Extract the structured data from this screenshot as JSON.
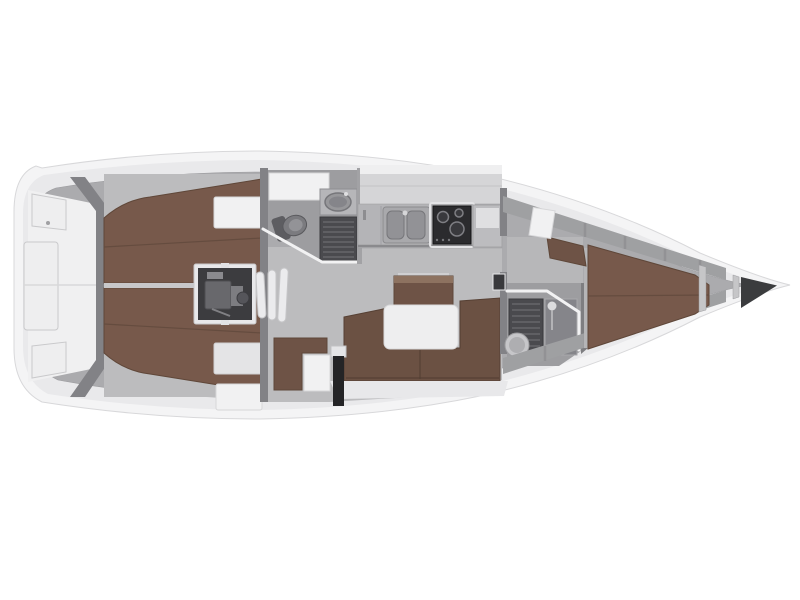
{
  "figure": "sailing-yacht-interior-deck-plan",
  "orientation": {
    "bow": "right",
    "stern": "left"
  },
  "rooms": [
    "aft-cabin-port",
    "aft-cabin-starboard",
    "engine-compartment",
    "companionway-steps",
    "aft-head",
    "galley",
    "saloon",
    "nav-station",
    "forward-head",
    "forward-cabin",
    "anchor-locker"
  ],
  "fixtures": [
    "double-berth-port",
    "double-berth-starboard",
    "engine-block",
    "toilet",
    "wash-basin",
    "shower-grate",
    "double-sink",
    "stove-oven",
    "saloon-table",
    "u-shaped-settee",
    "sideboard",
    "chart-table",
    "nav-seat",
    "mast-post",
    "v-berth",
    "vanity-seat",
    "wardrobe-lockers"
  ],
  "colors": {
    "bg": "#ffffff",
    "hull": "#f4f4f5",
    "hullEdge": "#d8d8da",
    "deck": "#e9e9eb",
    "deckLight": "#f0f0f1",
    "wall": "#ababae",
    "wallDark": "#828286",
    "floor": "#bcbcbe",
    "floorDark": "#9d9da0",
    "white": "#f1f1f2",
    "berth": "#77594b",
    "berthSeam": "#654c3f",
    "berthEdge": "#5f4739",
    "settee": "#6b5143",
    "wood": "#6e5346",
    "woodLight": "#8d7260",
    "counter": "#b4b4b7",
    "stove": "#2b2b2e",
    "engine": "#3c3c3f",
    "grate": "#4a4a4e",
    "dark": "#3b3c3e"
  }
}
